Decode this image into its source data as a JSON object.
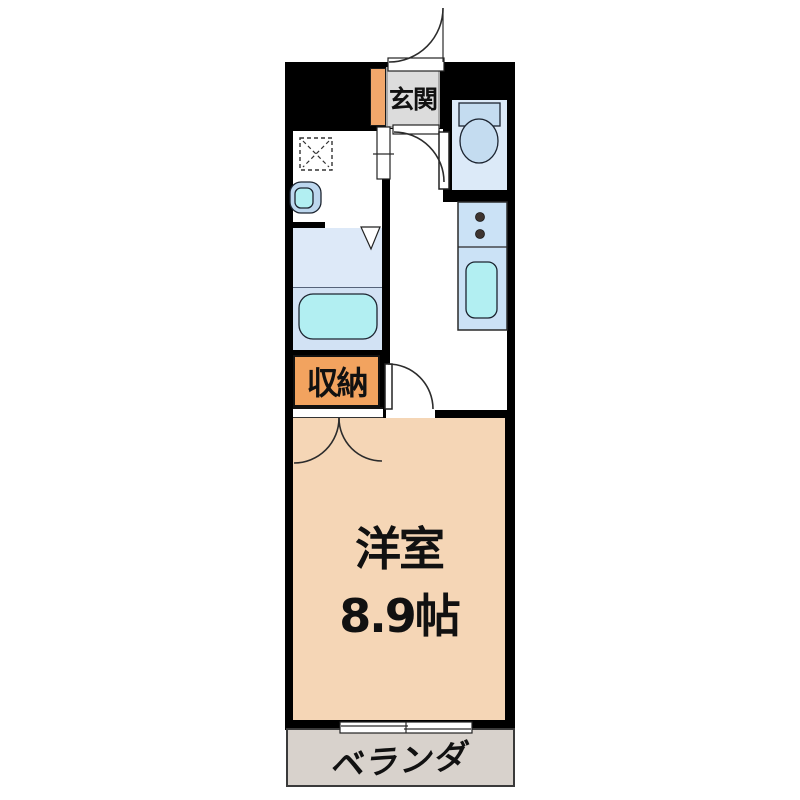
{
  "floorplan": {
    "rooms": {
      "genkan": {
        "label": "玄関"
      },
      "storage": {
        "label": "収納"
      },
      "main_room": {
        "label": "洋室",
        "size": "8.9帖"
      },
      "veranda": {
        "label": "ベランダ"
      }
    },
    "fixtures": {
      "toilet": "toilet",
      "bathtub": "bathtub",
      "kitchen_sink": "kitchen-sink",
      "stove": "two-burner-stove",
      "wash_basin": "wash-basin",
      "washer_pan": "washing-machine-pan",
      "entrance_door": "hinged-door",
      "hall_door": "hinged-door",
      "room_door": "hinged-door",
      "closet_doors": "double-hinged-doors",
      "bath_door": "folding-door",
      "washroom_door": "sliding-door",
      "balcony_window": "sliding-window"
    },
    "palette": {
      "wall": "#000000",
      "genkan_floor": "#dcdcdc",
      "shoebox_fill": "#f2a76b",
      "storage_fill": "#f2a35f",
      "room_floor": "#f5d6b6",
      "veranda_floor": "#d8d2cc",
      "wet_room_blue": "#dde9f8",
      "counter_blue": "#cbe2f6",
      "fixture_blue": "#c4dcf0",
      "water_cyan": "#b2eff2"
    }
  }
}
